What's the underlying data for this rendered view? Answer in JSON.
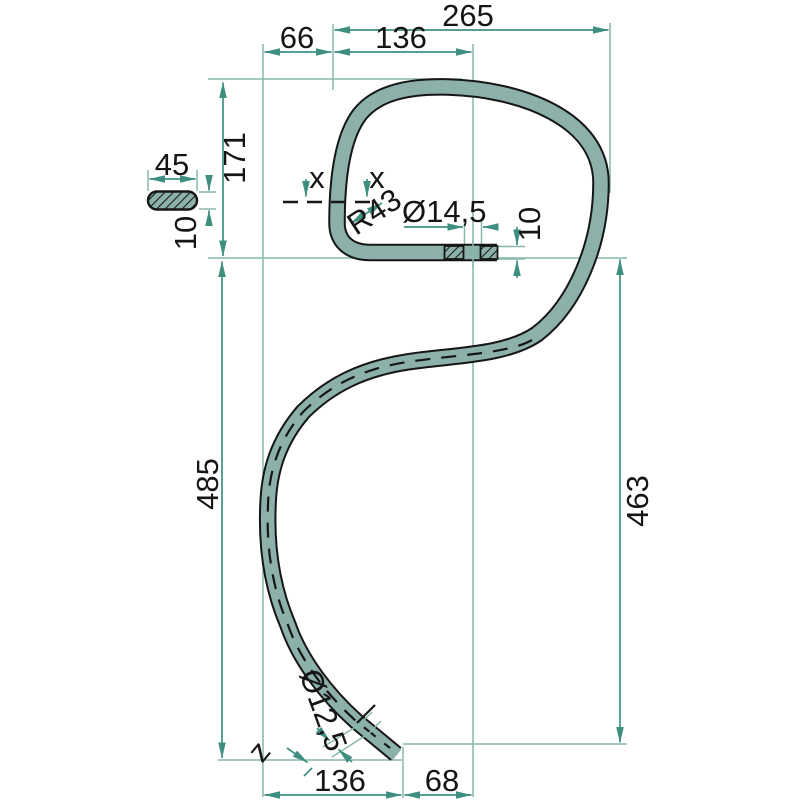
{
  "drawing": {
    "type": "technical-drawing-spring-tine",
    "labels": {
      "dim_265": "265",
      "dim_136_top": "136",
      "dim_66": "66",
      "dim_171": "171",
      "dim_485": "485",
      "dim_463": "463",
      "dim_45": "45",
      "dim_10_cross_section": "10",
      "dim_10_strip": "10",
      "dim_radius": "R43",
      "dim_hole_top": "Ø14,5",
      "dim_hole_tip": "Ø12,5",
      "section_x_left": "x",
      "section_x_right": "x",
      "tip_mark": "z",
      "dim_136_bottom": "136",
      "dim_68": "68"
    },
    "colors": {
      "background": "#ffffff",
      "tine_fill": "#8cb1ab",
      "outline": "#161616",
      "dimension_line": "#3f8f80",
      "extension_line": "#86b8ac",
      "text": "#151515"
    }
  }
}
